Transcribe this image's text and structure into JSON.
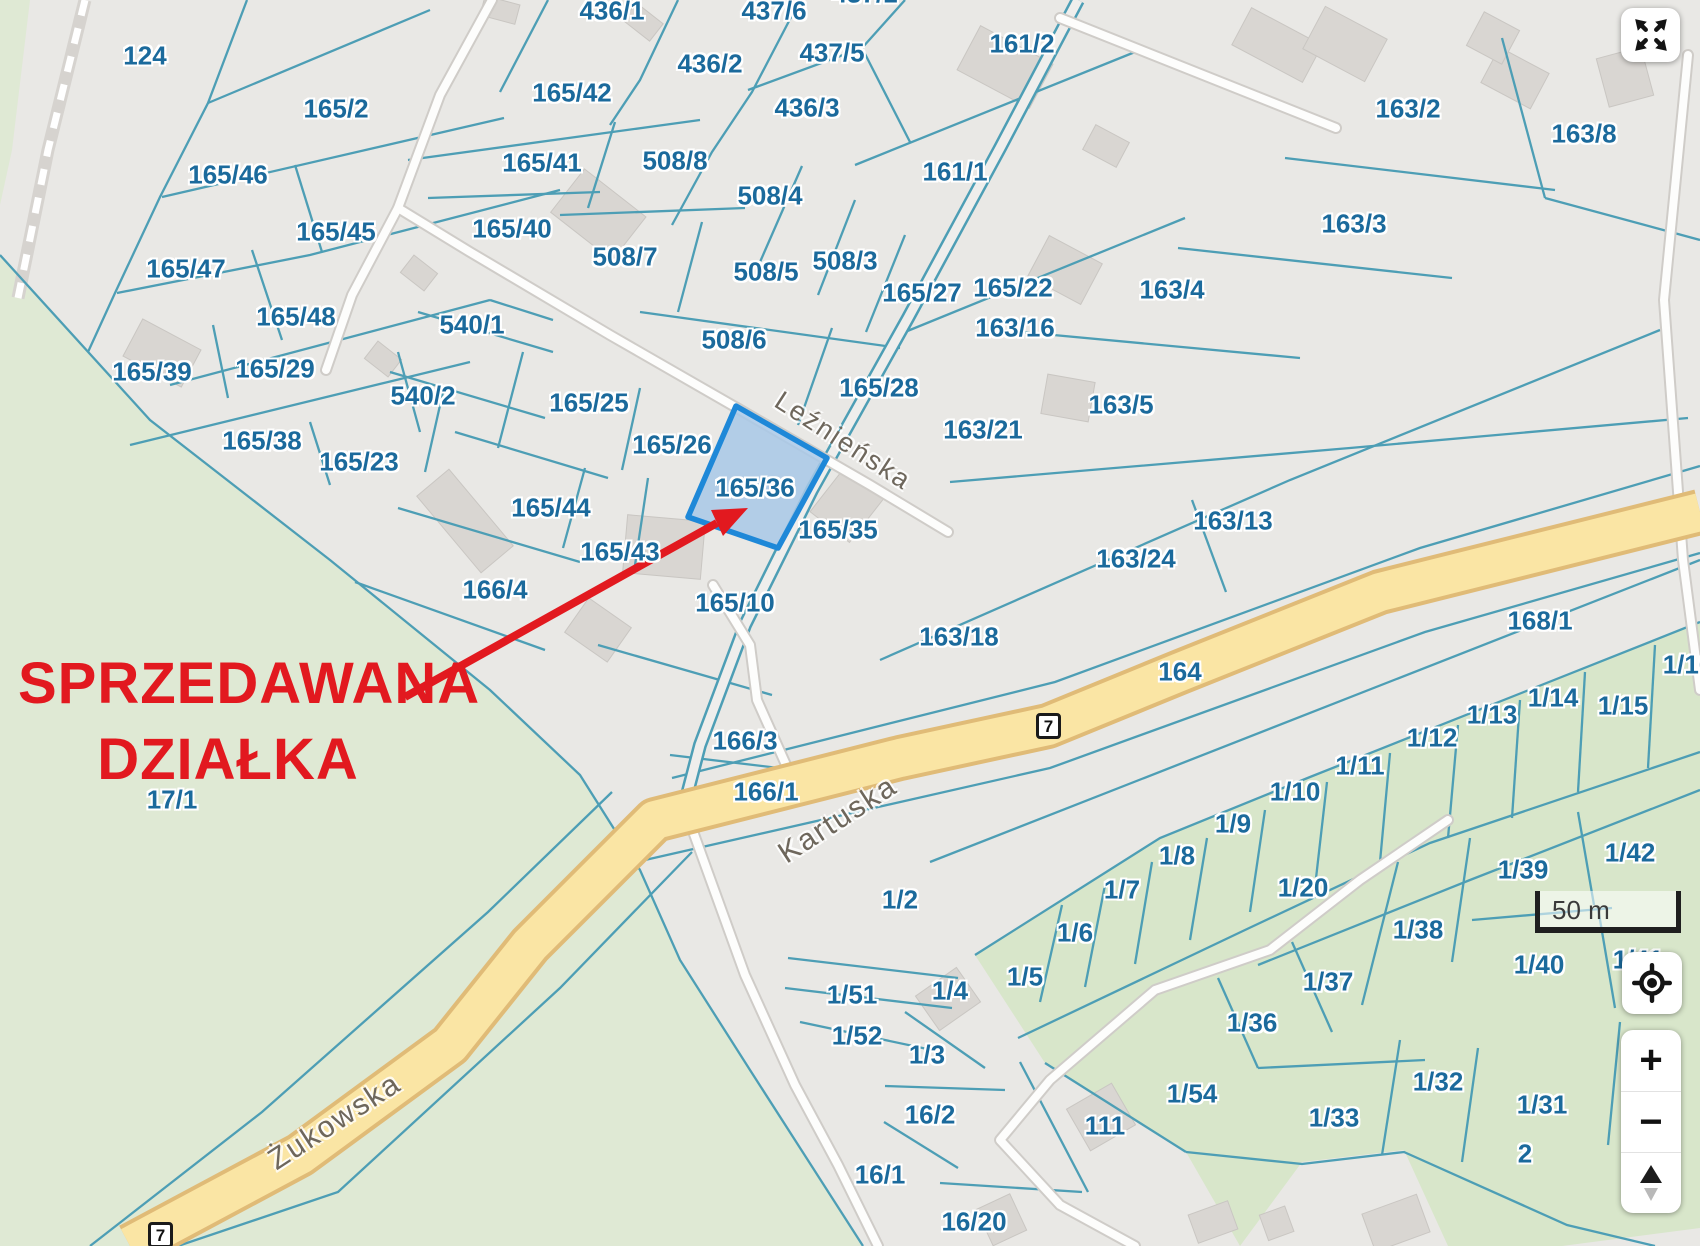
{
  "map": {
    "colors": {
      "background": "#e9e8e5",
      "green_area": "#dfe9d4",
      "green_parcels": "#d8e6ca",
      "parcel_line": "#4d9eb5",
      "parcel_label": "#1b6a9c",
      "highlight_fill": "#a8c8e8",
      "highlight_border": "#1e88d8",
      "road_yellow": "#fae5a4",
      "annotation_red": "#e2191f"
    },
    "annotation": {
      "line1": "SPRZEDAWANA",
      "line2": "DZIAŁKA"
    },
    "highlighted_parcel": "165/36",
    "scale_bar": {
      "text": "50 m"
    },
    "road_badges": [
      {
        "text": "7",
        "x": 1036,
        "y": 713
      },
      {
        "text": "7",
        "x": 148,
        "y": 1222
      }
    ],
    "streets": [
      {
        "name": "Leźnieńska",
        "x": 843,
        "y": 441,
        "rot": 33,
        "size": 27
      },
      {
        "name": "Kartuska",
        "x": 838,
        "y": 820,
        "rot": -33,
        "size": 30
      },
      {
        "name": "Żukowska",
        "x": 335,
        "y": 1122,
        "rot": -33,
        "size": 30
      }
    ],
    "parcels": [
      {
        "t": "124",
        "x": 145,
        "y": 56
      },
      {
        "t": "165/2",
        "x": 336,
        "y": 109
      },
      {
        "t": "165/46",
        "x": 228,
        "y": 175
      },
      {
        "t": "165/45",
        "x": 336,
        "y": 232
      },
      {
        "t": "165/47",
        "x": 186,
        "y": 269
      },
      {
        "t": "165/48",
        "x": 296,
        "y": 317
      },
      {
        "t": "165/39",
        "x": 152,
        "y": 372
      },
      {
        "t": "165/29",
        "x": 275,
        "y": 369
      },
      {
        "t": "165/38",
        "x": 262,
        "y": 441
      },
      {
        "t": "165/23",
        "x": 359,
        "y": 462
      },
      {
        "t": "540/1",
        "x": 472,
        "y": 325
      },
      {
        "t": "540/2",
        "x": 423,
        "y": 396
      },
      {
        "t": "165/42",
        "x": 572,
        "y": 93
      },
      {
        "t": "165/41",
        "x": 542,
        "y": 163
      },
      {
        "t": "165/40",
        "x": 512,
        "y": 229
      },
      {
        "t": "436/1",
        "x": 612,
        "y": 11
      },
      {
        "t": "437/6",
        "x": 774,
        "y": 11
      },
      {
        "t": "437/1",
        "x": 865,
        "y": -6
      },
      {
        "t": "437/5",
        "x": 832,
        "y": 53
      },
      {
        "t": "436/2",
        "x": 710,
        "y": 64
      },
      {
        "t": "436/3",
        "x": 807,
        "y": 108
      },
      {
        "t": "508/8",
        "x": 675,
        "y": 161
      },
      {
        "t": "508/4",
        "x": 770,
        "y": 196
      },
      {
        "t": "508/7",
        "x": 625,
        "y": 257
      },
      {
        "t": "508/5",
        "x": 766,
        "y": 272
      },
      {
        "t": "508/3",
        "x": 845,
        "y": 261
      },
      {
        "t": "508/6",
        "x": 734,
        "y": 340
      },
      {
        "t": "165/27",
        "x": 922,
        "y": 293
      },
      {
        "t": "165/22",
        "x": 1013,
        "y": 288
      },
      {
        "t": "163/16",
        "x": 1015,
        "y": 328
      },
      {
        "t": "165/28",
        "x": 879,
        "y": 388
      },
      {
        "t": "163/21",
        "x": 983,
        "y": 430
      },
      {
        "t": "161/2",
        "x": 1022,
        "y": 44
      },
      {
        "t": "161/1",
        "x": 955,
        "y": 172
      },
      {
        "t": "163/2",
        "x": 1408,
        "y": 109
      },
      {
        "t": "163/8",
        "x": 1584,
        "y": 134
      },
      {
        "t": "163/3",
        "x": 1354,
        "y": 224
      },
      {
        "t": "163/4",
        "x": 1172,
        "y": 290
      },
      {
        "t": "163/5",
        "x": 1121,
        "y": 405
      },
      {
        "t": "163/24",
        "x": 1136,
        "y": 559
      },
      {
        "t": "163/13",
        "x": 1233,
        "y": 521
      },
      {
        "t": "163/18",
        "x": 959,
        "y": 637
      },
      {
        "t": "164",
        "x": 1180,
        "y": 672
      },
      {
        "t": "165/25",
        "x": 589,
        "y": 403
      },
      {
        "t": "165/26",
        "x": 672,
        "y": 445
      },
      {
        "t": "165/36",
        "x": 755,
        "y": 488
      },
      {
        "t": "165/35",
        "x": 838,
        "y": 530
      },
      {
        "t": "165/44",
        "x": 551,
        "y": 508
      },
      {
        "t": "165/43",
        "x": 620,
        "y": 552
      },
      {
        "t": "166/4",
        "x": 495,
        "y": 590
      },
      {
        "t": "165/10",
        "x": 735,
        "y": 603
      },
      {
        "t": "166/3",
        "x": 745,
        "y": 741
      },
      {
        "t": "166/1",
        "x": 766,
        "y": 792
      },
      {
        "t": "168/1",
        "x": 1540,
        "y": 621
      },
      {
        "t": "1/16",
        "x": 1688,
        "y": 665
      },
      {
        "t": "1/14",
        "x": 1553,
        "y": 698
      },
      {
        "t": "1/15",
        "x": 1623,
        "y": 706
      },
      {
        "t": "1/13",
        "x": 1492,
        "y": 715
      },
      {
        "t": "1/12",
        "x": 1432,
        "y": 738
      },
      {
        "t": "1/11",
        "x": 1360,
        "y": 766
      },
      {
        "t": "1/10",
        "x": 1295,
        "y": 792
      },
      {
        "t": "1/9",
        "x": 1233,
        "y": 824
      },
      {
        "t": "1/8",
        "x": 1177,
        "y": 856
      },
      {
        "t": "1/7",
        "x": 1122,
        "y": 890
      },
      {
        "t": "1/6",
        "x": 1075,
        "y": 933
      },
      {
        "t": "1/5",
        "x": 1025,
        "y": 977
      },
      {
        "t": "1/2",
        "x": 900,
        "y": 900
      },
      {
        "t": "1/4",
        "x": 950,
        "y": 991
      },
      {
        "t": "1/51",
        "x": 852,
        "y": 995
      },
      {
        "t": "1/52",
        "x": 857,
        "y": 1036
      },
      {
        "t": "1/3",
        "x": 927,
        "y": 1055
      },
      {
        "t": "16/2",
        "x": 930,
        "y": 1115
      },
      {
        "t": "16/1",
        "x": 880,
        "y": 1175
      },
      {
        "t": "16/20",
        "x": 974,
        "y": 1222
      },
      {
        "t": "111",
        "x": 1105,
        "y": 1126
      },
      {
        "t": "1/54",
        "x": 1192,
        "y": 1094
      },
      {
        "t": "1/36",
        "x": 1252,
        "y": 1023
      },
      {
        "t": "1/37",
        "x": 1328,
        "y": 982
      },
      {
        "t": "1/33",
        "x": 1334,
        "y": 1118
      },
      {
        "t": "1/32",
        "x": 1438,
        "y": 1082
      },
      {
        "t": "1/31",
        "x": 1542,
        "y": 1105
      },
      {
        "t": "2",
        "x": 1525,
        "y": 1154
      },
      {
        "t": "1/20",
        "x": 1303,
        "y": 888
      },
      {
        "t": "1/38",
        "x": 1418,
        "y": 930
      },
      {
        "t": "1/39",
        "x": 1523,
        "y": 870
      },
      {
        "t": "1/42",
        "x": 1630,
        "y": 853
      },
      {
        "t": "1/40",
        "x": 1539,
        "y": 965
      },
      {
        "t": "1/41",
        "x": 1638,
        "y": 960
      },
      {
        "t": "17/1",
        "x": 172,
        "y": 800
      }
    ]
  },
  "controls": {
    "fullscreen_icon": "expand-arrows-icon",
    "locate_icon": "gps-target-icon",
    "zoom_in_label": "+",
    "zoom_out_label": "−",
    "compass_icon": "north-arrow-icon"
  }
}
